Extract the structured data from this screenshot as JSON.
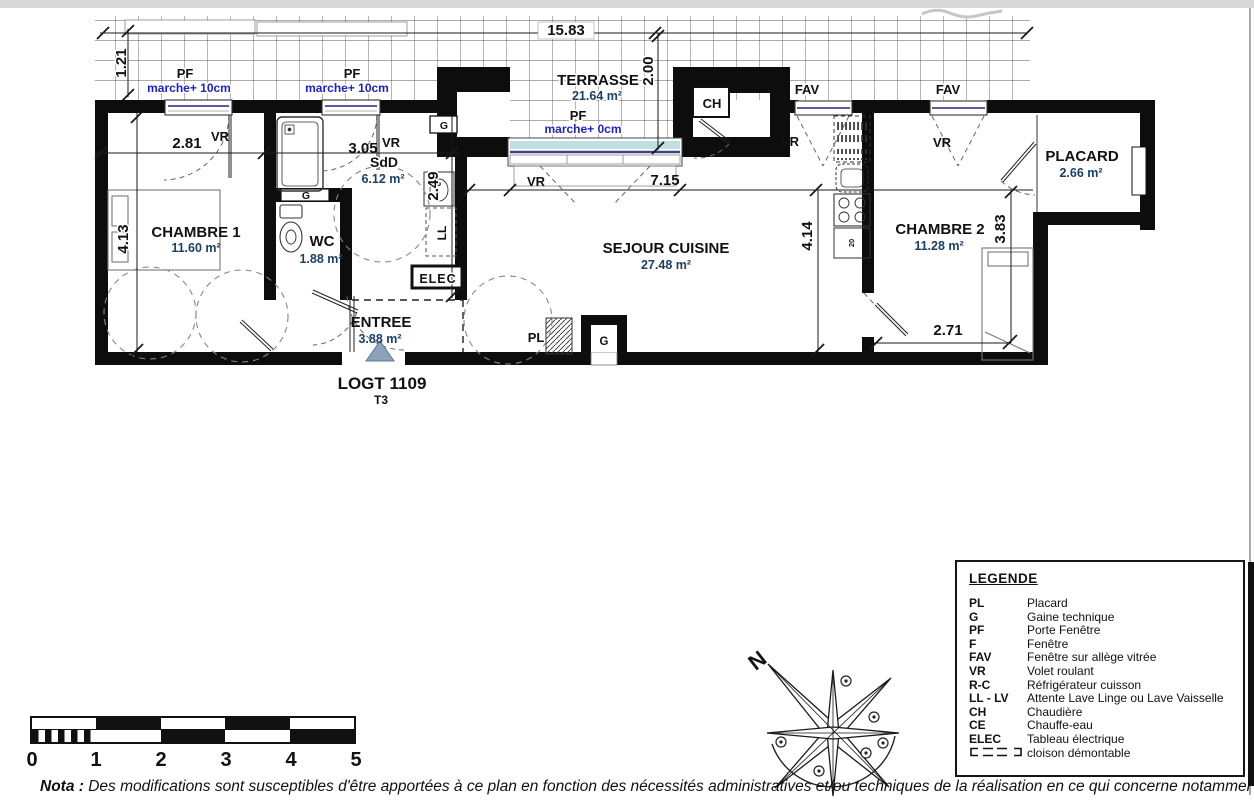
{
  "page": {
    "title": "LOGT 1109",
    "type_label": "T3"
  },
  "plan": {
    "rooms": [
      {
        "name": "CHAMBRE 1",
        "area": "11.60 m²"
      },
      {
        "name": "WC",
        "area": "1.88 m²"
      },
      {
        "name": "SdD",
        "area": "6.12 m²"
      },
      {
        "name": "ENTREE",
        "area": "3.88 m²"
      },
      {
        "name": "SEJOUR CUISINE",
        "area": "27.48 m²"
      },
      {
        "name": "CHAMBRE 2",
        "area": "11.28 m²"
      },
      {
        "name": "PLACARD",
        "area": "2.66 m²"
      },
      {
        "name": "TERRASSE",
        "area": "21.64 m²"
      }
    ],
    "dimensions": {
      "terrasse_w": "15.83",
      "terrasse_step": "1.21",
      "ch1_win": "2.81",
      "sdd_win": "3.05",
      "sdd_d": "2.49",
      "ch1_d": "4.13",
      "terrasse_d": "2.00",
      "sejour_w": "7.15",
      "sejour_d": "4.14",
      "ch2_d": "3.83",
      "ch2_w": "2.71"
    },
    "annotations": {
      "pf": "PF",
      "vr": "VR",
      "fav": "FAV",
      "ch": "CH",
      "g": "G",
      "pl": "PL",
      "ll": "LL",
      "elec": "ELEC",
      "marche10": "marche+ 10cm",
      "marche0": "marche+ 0cm",
      "twenty": "20"
    }
  },
  "legend": {
    "title": "LEGENDE",
    "items": [
      {
        "abbr": "PL",
        "label": "Placard"
      },
      {
        "abbr": "G",
        "label": "Gaine technique"
      },
      {
        "abbr": "PF",
        "label": "Porte Fenêtre"
      },
      {
        "abbr": "F",
        "label": "Fenêtre"
      },
      {
        "abbr": "FAV",
        "label": "Fenêtre sur allège vitrée"
      },
      {
        "abbr": "VR",
        "label": "Volet roulant"
      },
      {
        "abbr": "R-C",
        "label": "Réfrigérateur cuisson"
      },
      {
        "abbr": "LL - LV",
        "label": "Attente Lave Linge ou Lave Vaisselle"
      },
      {
        "abbr": "CH",
        "label": "Chaudière"
      },
      {
        "abbr": "CE",
        "label": "Chauffe-eau"
      },
      {
        "abbr": "ELEC",
        "label": "Tableau électrique"
      },
      {
        "abbr": "",
        "label": "cloison démontable"
      }
    ]
  },
  "scalebar": {
    "labels": [
      "0",
      "1",
      "2",
      "3",
      "4",
      "5"
    ]
  },
  "compass": {
    "north": "N"
  },
  "nota": {
    "prefix": "Nota :",
    "text": " Des modifications sont susceptibles d'être apportées à ce plan en fonction des nécessités administratives et/ou techniques de la réalisation en ce qui concerne notamment les di"
  },
  "colors": {
    "wall": "#0d0d0d",
    "area_text": "#1c3f66",
    "marche_blue": "#1e22cc",
    "glazing": "#bfe0e2",
    "entrance_arrow": "#8ba3b8"
  }
}
